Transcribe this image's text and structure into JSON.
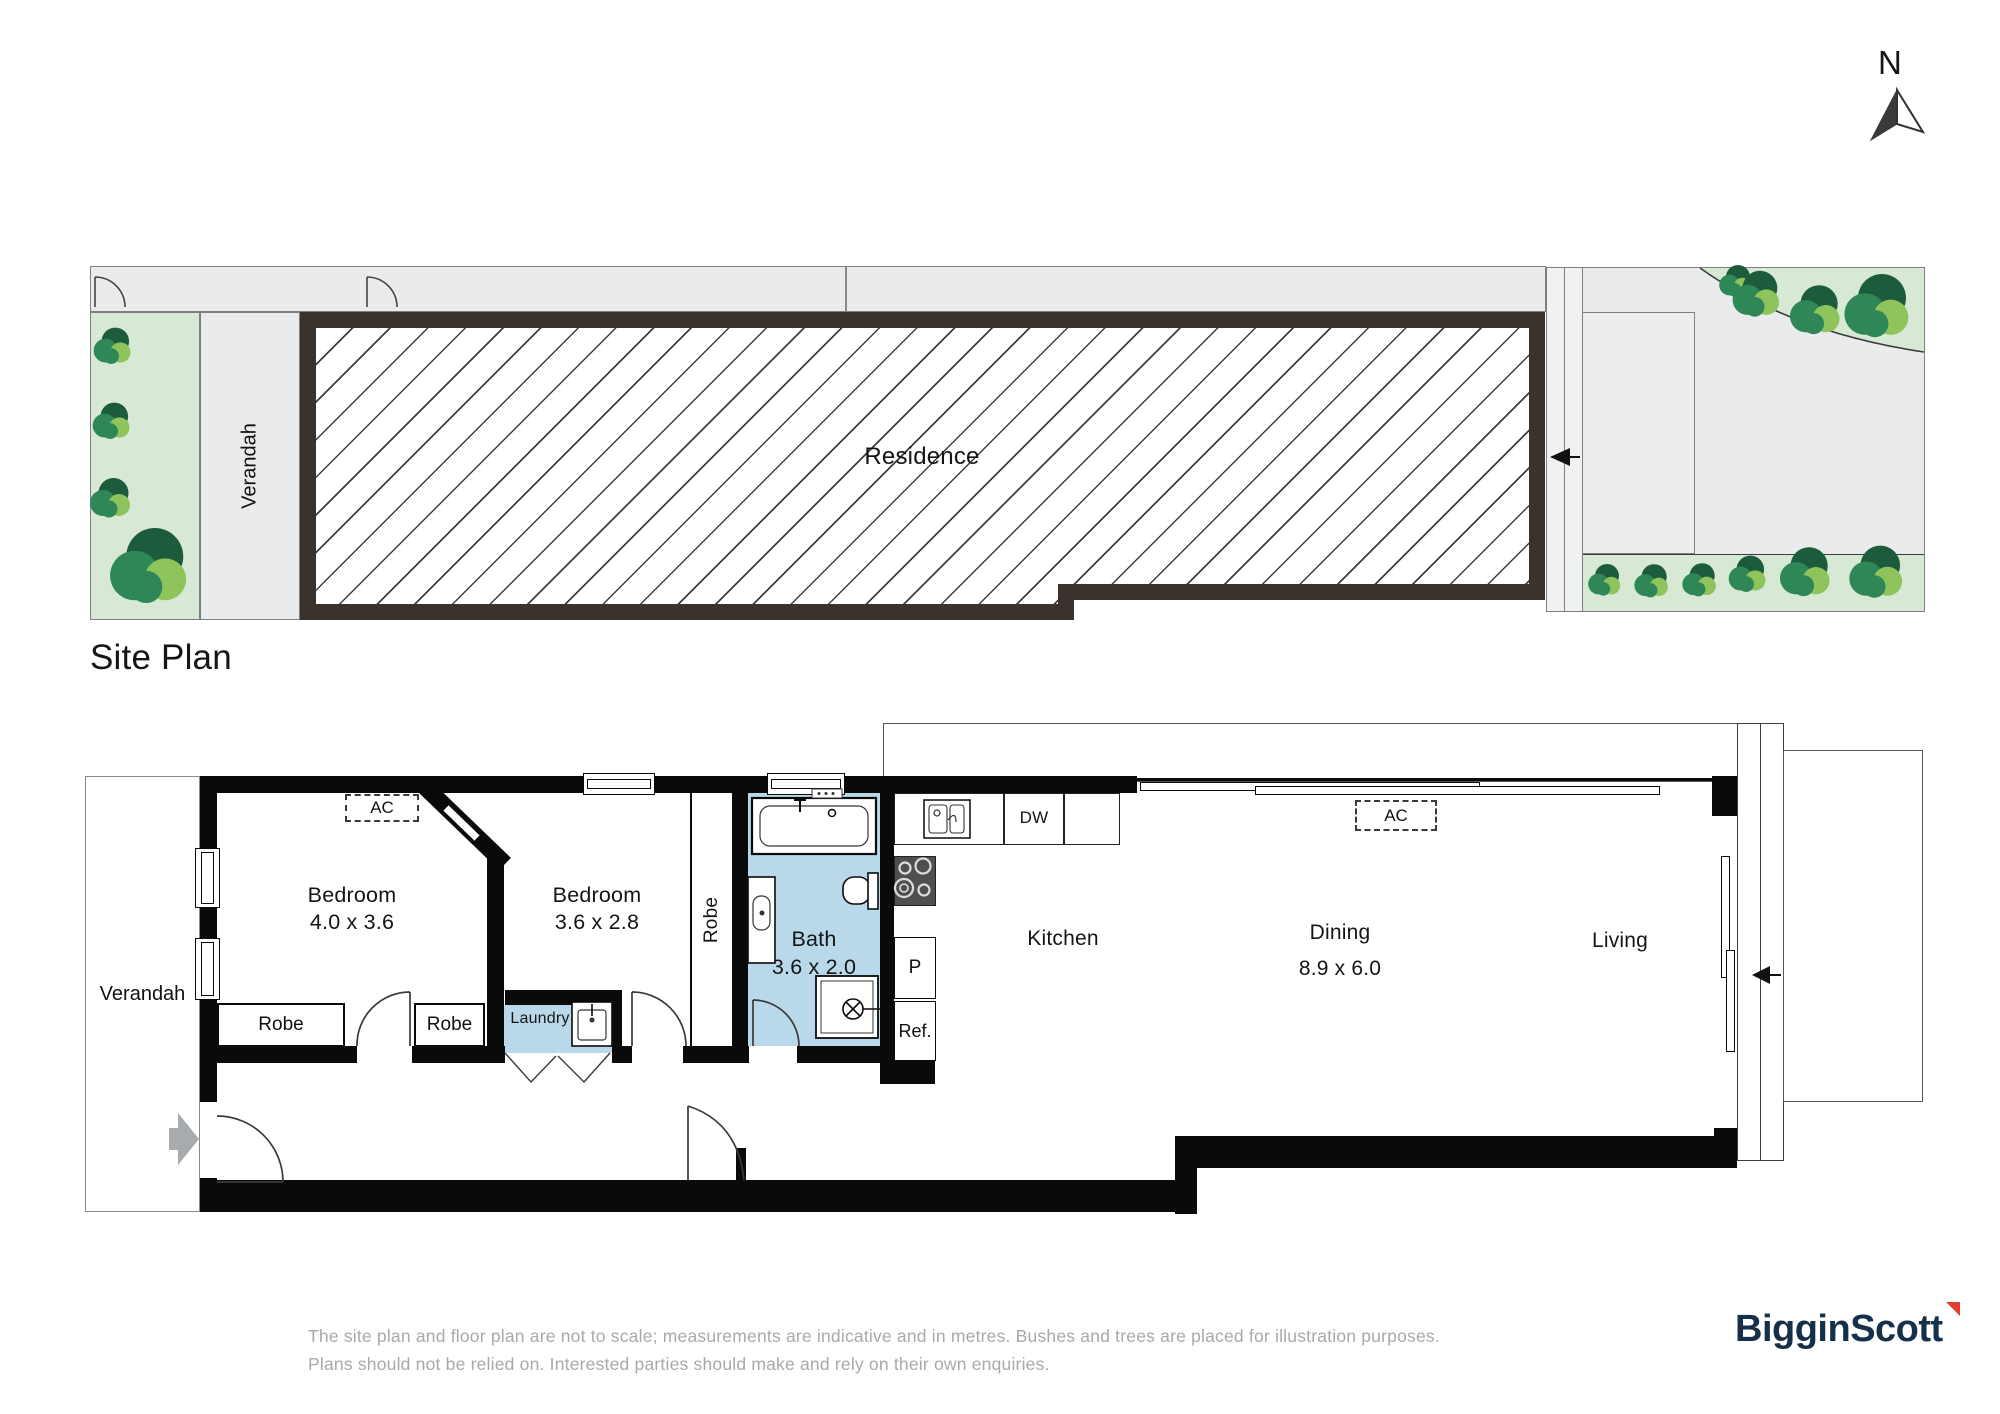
{
  "compass": {
    "label": "N"
  },
  "site_plan": {
    "title": "Site Plan",
    "verandah": "Verandah",
    "residence": "Residence",
    "bushes": [
      {
        "x": 113,
        "y": 346,
        "s": 46
      },
      {
        "x": 112,
        "y": 421,
        "s": 46
      },
      {
        "x": 111,
        "y": 498,
        "s": 50
      },
      {
        "x": 150,
        "y": 566,
        "s": 95
      },
      {
        "x": 1605,
        "y": 580,
        "s": 40
      },
      {
        "x": 1652,
        "y": 581,
        "s": 42
      },
      {
        "x": 1700,
        "y": 580,
        "s": 42
      },
      {
        "x": 1748,
        "y": 574,
        "s": 46
      },
      {
        "x": 1806,
        "y": 572,
        "s": 62
      },
      {
        "x": 1877,
        "y": 572,
        "s": 66
      },
      {
        "x": 1736,
        "y": 281,
        "s": 40
      },
      {
        "x": 1757,
        "y": 294,
        "s": 58
      },
      {
        "x": 1816,
        "y": 310,
        "s": 62
      },
      {
        "x": 1878,
        "y": 306,
        "s": 80
      }
    ]
  },
  "floor_plan": {
    "verandah": "Verandah",
    "bedroom1": {
      "name": "Bedroom",
      "dims": "4.0 x 3.6"
    },
    "bedroom2": {
      "name": "Bedroom",
      "dims": "3.6 x 2.8"
    },
    "bath": {
      "name": "Bath",
      "dims": "3.6 x 2.0"
    },
    "kitchen": "Kitchen",
    "dining": {
      "name": "Dining",
      "dims": "8.9 x 6.0"
    },
    "living": "Living",
    "robe_bed1_left": "Robe",
    "robe_bed1_right": "Robe",
    "robe_hall": "Robe",
    "laundry": "Laundry",
    "ac_bedroom": "AC",
    "ac_living": "AC",
    "dw": "DW",
    "pantry": "P",
    "fridge": "Ref."
  },
  "footer": {
    "disclaimer_line1": "The site plan and floor plan are not to scale; measurements are indicative and in metres. Bushes and trees are placed for illustration purposes.",
    "disclaimer_line2": "Plans should not be relied on. Interested parties should make and rely on their own enquiries.",
    "brand": "BigginScott"
  },
  "colors": {
    "wall_floorplan": "#0a0a0a",
    "wall_siteplan": "#3a322d",
    "room_blue": "#b9d9ea",
    "gray_fill": "#eaebec",
    "green_light": "#d7e9d5",
    "bush_dark": "#1c5c3c",
    "bush_mid": "#2f8656",
    "bush_light": "#8fc45c",
    "logo_navy": "#16304a",
    "logo_red": "#e2402f",
    "disclaimer_gray": "#a9a9a9"
  }
}
